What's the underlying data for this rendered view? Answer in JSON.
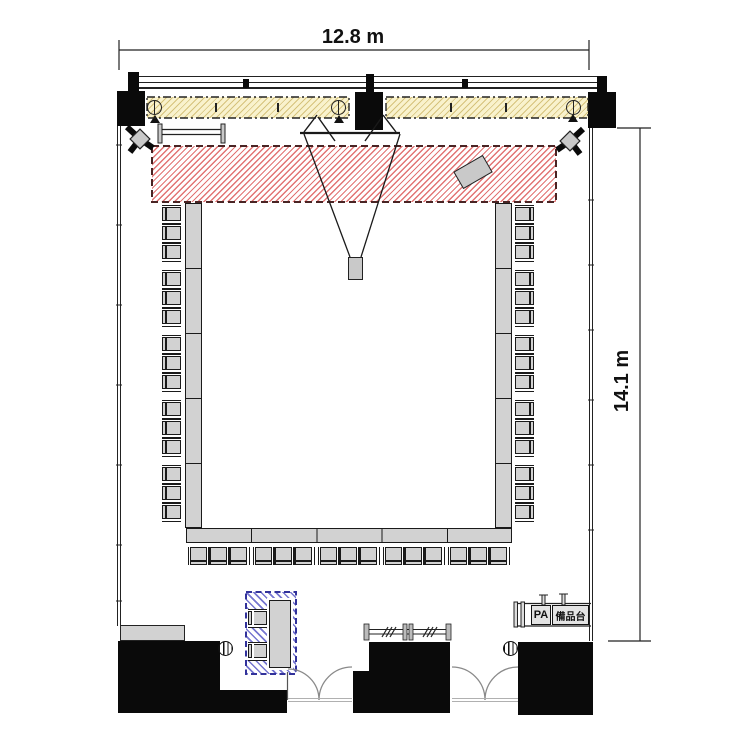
{
  "dimensions": {
    "width": "12.8 m",
    "height": "14.1 m"
  },
  "labels": {
    "pa": "PA",
    "equipment_stand": "備品台"
  },
  "colors": {
    "wall": "#0a0a0a",
    "furniture": "#d2d2d2",
    "screen_fill": "#f9f2cd",
    "stage_hatch": "#dd5c5c",
    "stage_border": "#4a2424",
    "reception_hatch": "#5454c4",
    "reception_border": "#32329b",
    "line": "#1a1a1a"
  },
  "layout": {
    "table_shape": "U-shape open toward stage",
    "side_segments": 5,
    "chairs_per_segment": 3,
    "left_chairs": 15,
    "right_chairs": 15,
    "bottom_chairs": 15,
    "reception_chairs": 2,
    "round_stools": 2,
    "screens": 3,
    "speakers": 2,
    "coat_racks": 2,
    "entrance_doors": 2
  }
}
